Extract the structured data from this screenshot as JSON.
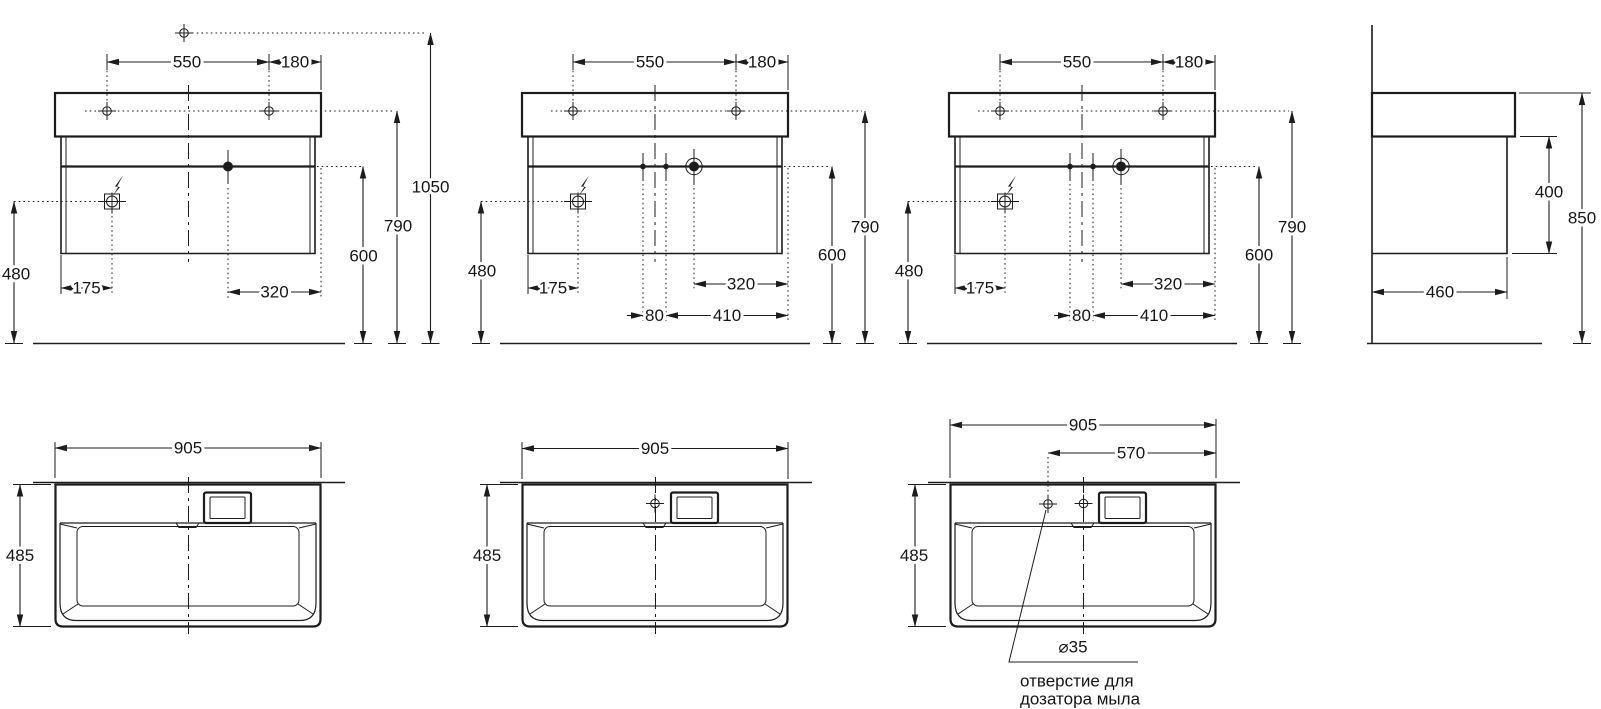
{
  "drawing": {
    "front1": {
      "hole_spacing": "550",
      "hole_to_edge": "180",
      "mixer_height": "1050",
      "holes_height": "790",
      "siphon_height": "600",
      "outlet_height": "480",
      "outlet_from_left": "175",
      "drain_from_right": "320"
    },
    "front2": {
      "hole_spacing": "550",
      "hole_to_edge": "180",
      "holes_height": "790",
      "siphon_height": "600",
      "outlet_height": "480",
      "outlet_from_left": "175",
      "drain_from_right": "320",
      "supply_spacing": "80",
      "supply_from_right": "410"
    },
    "front3": {
      "hole_spacing": "550",
      "hole_to_edge": "180",
      "holes_height": "790",
      "siphon_height": "600",
      "outlet_height": "480",
      "outlet_from_left": "175",
      "drain_from_right": "320",
      "supply_spacing": "80",
      "supply_from_right": "410"
    },
    "side": {
      "cabinet_height": "400",
      "overall_height": "850",
      "depth": "460"
    },
    "plan1": {
      "width": "905",
      "depth": "485"
    },
    "plan2": {
      "width": "905",
      "depth": "485"
    },
    "plan3": {
      "width": "905",
      "depth": "485",
      "dispenser_from_right": "570",
      "hole_diameter": "⌀35",
      "note_line1": "отверстие для",
      "note_line2": "дозатора мыла"
    }
  }
}
